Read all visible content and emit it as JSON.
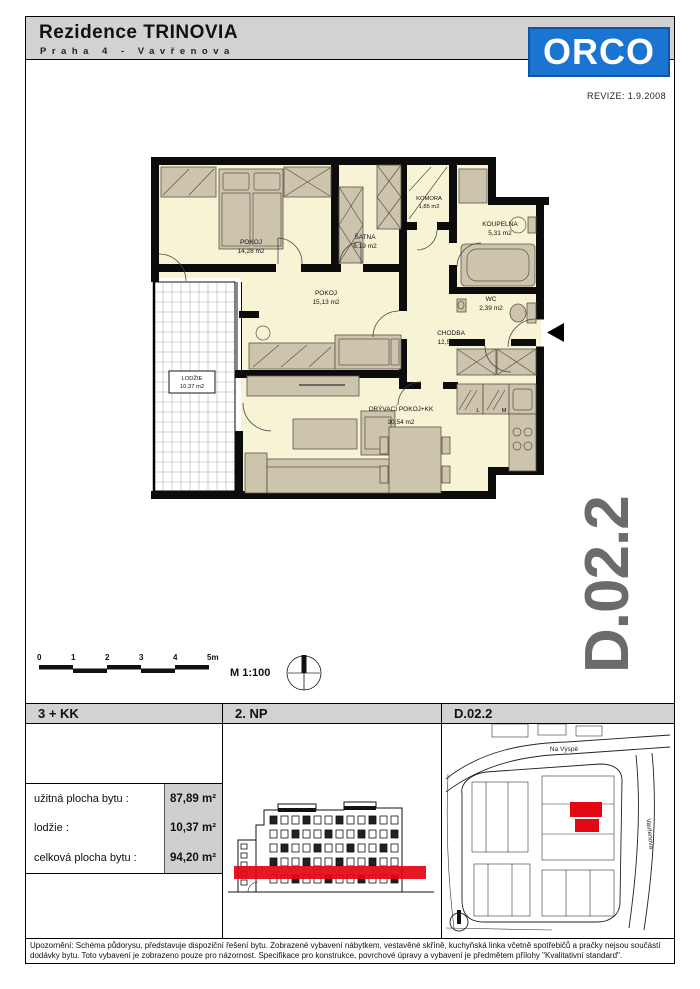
{
  "header": {
    "title": "Rezidence TRINOVIA",
    "subtitle": "Praha 4 - Vavřenova",
    "logo_text": "ORCO",
    "revision": "REVIZE: 1.9.2008"
  },
  "unit_code": "D.02.2",
  "colors": {
    "logo_blue": "#1b74d2",
    "header_gray": "#d2d2d2",
    "accent_red": "#e30613",
    "unit_code_gray": "#6b6b6b",
    "plan_floor": "#f7f4d6",
    "furniture_tan": "#cdc4ae"
  },
  "plan": {
    "rooms": [
      {
        "name": "POKOJ",
        "area": "14,28 m2"
      },
      {
        "name": "ŠATNA",
        "area": "6,19 m2"
      },
      {
        "name": "KOMORA",
        "area": "1,85 m2"
      },
      {
        "name": "KOUPELNA",
        "area": "5,31 m2"
      },
      {
        "name": "WC",
        "area": "2,39 m2"
      },
      {
        "name": "CHODBA",
        "area": "12,50 m2"
      },
      {
        "name": "POKOJ",
        "area": "15,13 m2"
      },
      {
        "name": "OBÝVACÍ POKOJ+KK",
        "area": "30,54 m2"
      },
      {
        "name": "LODŽIE",
        "area": "10,37 m2"
      }
    ],
    "kitchen_letters": [
      "L",
      "M"
    ]
  },
  "scale": {
    "ticks": [
      "0",
      "1",
      "2",
      "3",
      "4",
      "5m"
    ],
    "ratio": "M 1:100"
  },
  "columns": {
    "col1": "3 + KK",
    "col2": "2. NP",
    "col3": "D.02.2"
  },
  "area_table": {
    "rows": [
      {
        "label": "užitná plocha bytu :",
        "value": "87,89 m²"
      },
      {
        "label": "lodžie :",
        "value": "10,37 m²"
      },
      {
        "label": "celková plocha bytu :",
        "value": "94,20 m²"
      }
    ]
  },
  "map": {
    "streets": [
      "Na Výspě",
      "Vavřenova"
    ]
  },
  "disclaimer": {
    "line1": "Upozornění: Schéma půdorysu, představuje dispoziční řešení bytu. Zobrazené vybavení nábytkem, vestavěné skříně, kuchyňská linka včetně spotřebičů a pračky nejsou součástí",
    "line2": "dodávky bytu. Toto vybavení je zobrazeno pouze pro názornost. Specifikace pro konstrukce, povrchové úpravy a vybavení je předmětem přílohy \"Kvalitativní standard\"."
  }
}
